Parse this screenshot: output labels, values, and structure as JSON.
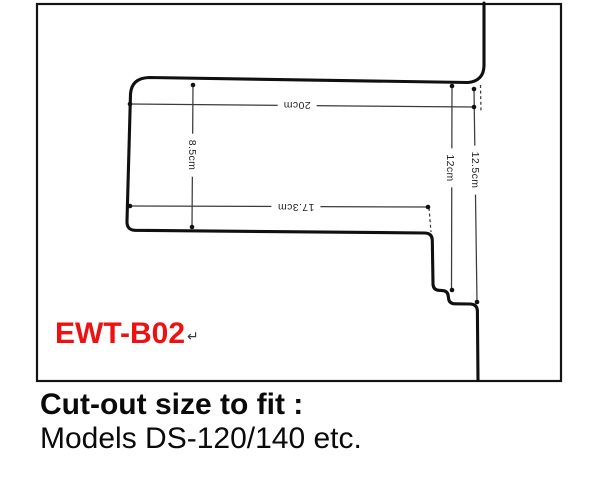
{
  "colors": {
    "model_label": "#ee1111",
    "outline": "#101010",
    "dimension_line": "#3b3b3b"
  },
  "diagram": {
    "model_label": "EWT-B02",
    "return_mark": "↵",
    "dimensions": {
      "top_width": "20cm",
      "bottom_width": "17.3cm",
      "left_height": "8.5cm",
      "right_depth": "12cm",
      "far_right_depth": "12.5cm"
    }
  },
  "caption": {
    "title": "Cut-out size to fit :",
    "subtitle": "Models DS-120/140 etc."
  }
}
